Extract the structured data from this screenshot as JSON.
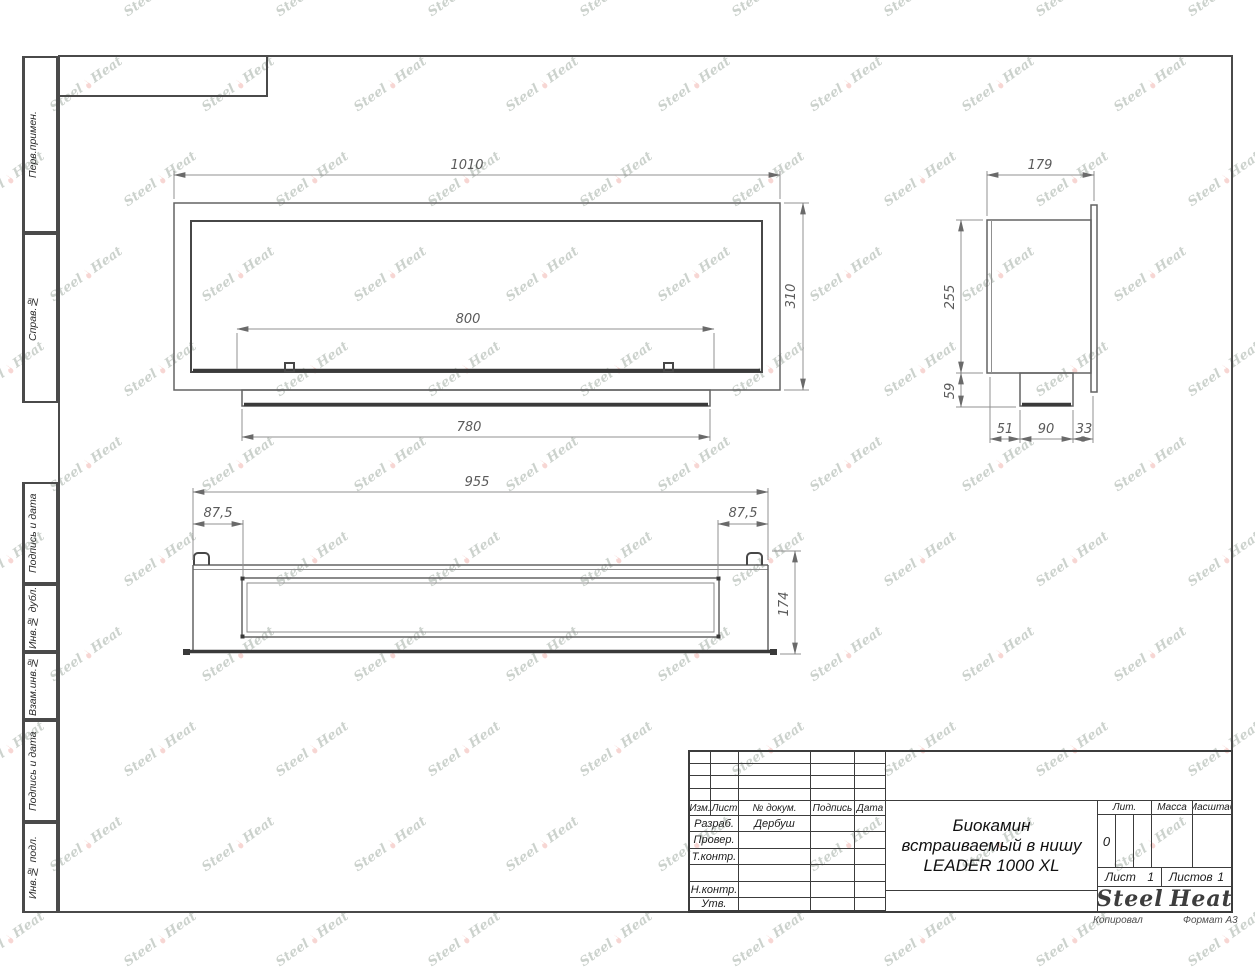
{
  "margin_labels": [
    "Перв.примен.",
    "Справ.№",
    "Подпись и дата",
    "Инв.№ дубл.",
    "Взам.инв.№",
    "Подпись и дата",
    "Инв.№ подл."
  ],
  "watermark": {
    "word1": "Steel",
    "word2": "Heat"
  },
  "dims": {
    "front": {
      "overall_width": "1010",
      "overall_height": "310",
      "opening_width": "800",
      "tray_width": "780"
    },
    "side": {
      "overall_depth": "179",
      "body_height": "255",
      "tray_drop": "59",
      "seg_back": "51",
      "seg_tray": "90",
      "seg_front": "33"
    },
    "plan": {
      "overall_width": "955",
      "offset_left": "87,5",
      "offset_right": "87,5",
      "overall_depth": "174"
    }
  },
  "title_block": {
    "revision_header": {
      "izm": "Изм.",
      "list": "Лист",
      "doc": "№ докум.",
      "sign": "Подпись",
      "date": "Дата"
    },
    "staff_rows": [
      {
        "label": "Разраб.",
        "value": "Дербуш"
      },
      {
        "label": "Провер.",
        "value": ""
      },
      {
        "label": "Т.контр.",
        "value": ""
      },
      {
        "label": "",
        "value": ""
      },
      {
        "label": "Н.контр.",
        "value": ""
      },
      {
        "label": "Утв.",
        "value": ""
      }
    ],
    "doc_title_lines": [
      "Биокамин",
      "встраиваемый в нишу",
      "LEADER 1000 XL"
    ],
    "lit": {
      "label": "Лит.",
      "value": "0"
    },
    "mass": {
      "label": "Масса",
      "value": ""
    },
    "scale": {
      "label": "Масштаб",
      "value": ""
    },
    "sheet_no": {
      "label": "Лист",
      "value": "1"
    },
    "sheets_total": {
      "label": "Листов",
      "value": "1"
    },
    "logo": {
      "word1": "Steel",
      "word2": "Heat"
    }
  },
  "footer": {
    "copied": "Копировал",
    "format": "Формат А3"
  }
}
